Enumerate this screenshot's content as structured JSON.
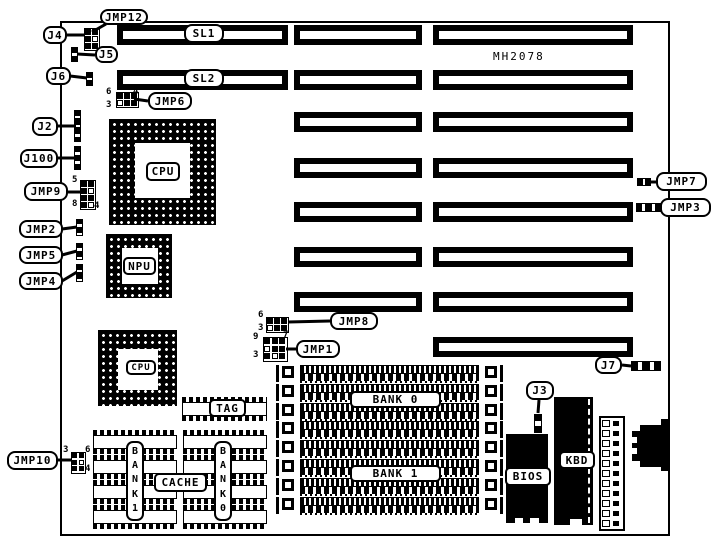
{
  "palette": {
    "ink": "#000000",
    "paper": "#ffffff"
  },
  "board": {
    "x": 60,
    "y": 21,
    "w": 610,
    "h": 515,
    "model_text": "MH2078",
    "model": {
      "x": 493,
      "y": 50,
      "w": 62,
      "h": 14
    }
  },
  "slots": [
    {
      "x": 117,
      "y": 25,
      "w": 171,
      "h": 20
    },
    {
      "x": 294,
      "y": 25,
      "w": 128,
      "h": 20
    },
    {
      "x": 433,
      "y": 25,
      "w": 200,
      "h": 20
    },
    {
      "x": 117,
      "y": 70,
      "w": 171,
      "h": 20
    },
    {
      "x": 294,
      "y": 70,
      "w": 128,
      "h": 20
    },
    {
      "x": 433,
      "y": 70,
      "w": 200,
      "h": 20
    },
    {
      "x": 294,
      "y": 112,
      "w": 128,
      "h": 20
    },
    {
      "x": 433,
      "y": 112,
      "w": 200,
      "h": 20
    },
    {
      "x": 294,
      "y": 158,
      "w": 128,
      "h": 20
    },
    {
      "x": 433,
      "y": 158,
      "w": 200,
      "h": 20
    },
    {
      "x": 294,
      "y": 202,
      "w": 128,
      "h": 20
    },
    {
      "x": 433,
      "y": 202,
      "w": 200,
      "h": 20
    },
    {
      "x": 294,
      "y": 247,
      "w": 128,
      "h": 20
    },
    {
      "x": 433,
      "y": 247,
      "w": 200,
      "h": 20
    },
    {
      "x": 294,
      "y": 292,
      "w": 128,
      "h": 20
    },
    {
      "x": 433,
      "y": 292,
      "w": 200,
      "h": 20
    },
    {
      "x": 433,
      "y": 337,
      "w": 200,
      "h": 20
    }
  ],
  "sockets": [
    {
      "name": "cpu-socket",
      "label": "CPU",
      "x": 109,
      "y": 119,
      "w": 107,
      "h": 106,
      "inner": [
        26,
        24,
        55,
        55
      ],
      "box": {
        "x": 146,
        "y": 162,
        "w": 34,
        "h": 19
      },
      "fs": 11
    },
    {
      "name": "npu-socket",
      "label": "NPU",
      "x": 106,
      "y": 234,
      "w": 66,
      "h": 64,
      "inner": [
        16,
        14,
        36,
        36
      ],
      "box": {
        "x": 123,
        "y": 257,
        "w": 33,
        "h": 18
      },
      "fs": 11
    },
    {
      "name": "cpu2-socket",
      "label": "CPU",
      "x": 98,
      "y": 330,
      "w": 79,
      "h": 76,
      "inner": [
        20,
        19,
        40,
        41
      ],
      "box": {
        "x": 126,
        "y": 360,
        "w": 30,
        "h": 15
      },
      "fs": 9
    }
  ],
  "cpu2_pin1_marker": {
    "x": 148,
    "y": 378,
    "w": 5,
    "h": 5
  },
  "simm": {
    "x": 276,
    "w": 227,
    "h": 17,
    "row_ys": [
      365,
      384,
      403,
      421,
      440,
      459,
      478,
      497
    ],
    "bank_labels": [
      {
        "text": "BANK 0",
        "x": 350,
        "y": 391,
        "w": 91,
        "h": 17
      },
      {
        "text": "BANK 1",
        "x": 350,
        "y": 465,
        "w": 91,
        "h": 17
      }
    ]
  },
  "dip_chips": [
    {
      "x": 182,
      "y": 397,
      "w": 85,
      "h": 24
    },
    {
      "x": 93,
      "y": 430,
      "w": 84,
      "h": 24
    },
    {
      "x": 93,
      "y": 455,
      "w": 84,
      "h": 24
    },
    {
      "x": 93,
      "y": 480,
      "w": 84,
      "h": 24
    },
    {
      "x": 93,
      "y": 505,
      "w": 84,
      "h": 24
    },
    {
      "x": 183,
      "y": 430,
      "w": 84,
      "h": 24
    },
    {
      "x": 183,
      "y": 455,
      "w": 84,
      "h": 24
    },
    {
      "x": 183,
      "y": 480,
      "w": 84,
      "h": 24
    },
    {
      "x": 183,
      "y": 505,
      "w": 84,
      "h": 24
    }
  ],
  "vlabels": [
    {
      "name": "cache-bank1-label",
      "text": "B\nA\nN\nK\n1",
      "x": 126,
      "y": 441,
      "w": 18,
      "h": 80
    },
    {
      "name": "cache-bank0-label",
      "text": "B\nA\nN\nK\n0",
      "x": 214,
      "y": 441,
      "w": 18,
      "h": 80
    }
  ],
  "comp_labels": [
    {
      "name": "tag-chip-label",
      "text": "TAG",
      "x": 209,
      "y": 399,
      "w": 37,
      "h": 18
    },
    {
      "name": "cache-label",
      "text": "CACHE",
      "x": 154,
      "y": 473,
      "w": 53,
      "h": 19
    },
    {
      "name": "bios-chip-label",
      "text": "BIOS",
      "x": 505,
      "y": 467,
      "w": 46,
      "h": 19
    },
    {
      "name": "kbd-chip-label",
      "text": "KBD",
      "x": 559,
      "y": 451,
      "w": 36,
      "h": 18
    }
  ],
  "callouts": [
    {
      "id": "jmp12",
      "text": "JMP12",
      "x": 100,
      "y": 9,
      "w": 48,
      "h": 16,
      "tail": [
        106,
        24,
        92,
        32
      ]
    },
    {
      "id": "j4",
      "text": "J4",
      "x": 43,
      "y": 26,
      "w": 24,
      "h": 18,
      "tail": [
        66,
        35,
        85,
        35
      ]
    },
    {
      "id": "j5",
      "text": "J5",
      "x": 95,
      "y": 46,
      "w": 23,
      "h": 17,
      "tail": [
        95,
        55,
        77,
        54
      ]
    },
    {
      "id": "j6",
      "text": "J6",
      "x": 46,
      "y": 67,
      "w": 25,
      "h": 18,
      "tail": [
        70,
        76,
        87,
        78
      ]
    },
    {
      "id": "jmp6",
      "text": "JMP6",
      "x": 148,
      "y": 92,
      "w": 44,
      "h": 18,
      "tail": [
        148,
        101,
        134,
        99
      ]
    },
    {
      "id": "j2",
      "text": "J2",
      "x": 32,
      "y": 117,
      "w": 26,
      "h": 19,
      "tail": [
        57,
        126,
        76,
        126
      ]
    },
    {
      "id": "j100",
      "text": "J100",
      "x": 20,
      "y": 149,
      "w": 38,
      "h": 19,
      "tail": [
        57,
        158,
        75,
        158
      ]
    },
    {
      "id": "jmp9",
      "text": "JMP9",
      "x": 24,
      "y": 182,
      "w": 44,
      "h": 19,
      "tail": [
        67,
        192,
        81,
        192
      ]
    },
    {
      "id": "jmp2",
      "text": "JMP2",
      "x": 19,
      "y": 220,
      "w": 44,
      "h": 18,
      "tail": [
        62,
        229,
        77,
        227
      ]
    },
    {
      "id": "jmp5",
      "text": "JMP5",
      "x": 19,
      "y": 246,
      "w": 44,
      "h": 18,
      "tail": [
        62,
        255,
        77,
        251
      ]
    },
    {
      "id": "jmp4",
      "text": "JMP4",
      "x": 19,
      "y": 272,
      "w": 44,
      "h": 18,
      "tail": [
        62,
        281,
        77,
        272
      ]
    },
    {
      "id": "jmp7",
      "text": "JMP7",
      "x": 656,
      "y": 172,
      "w": 51,
      "h": 19,
      "tail": [
        657,
        182,
        650,
        182
      ]
    },
    {
      "id": "jmp3",
      "text": "JMP3",
      "x": 660,
      "y": 198,
      "w": 51,
      "h": 19,
      "tail": [
        662,
        208,
        659,
        207
      ]
    },
    {
      "id": "jmp8",
      "text": "JMP8",
      "x": 330,
      "y": 312,
      "w": 48,
      "h": 18,
      "tail": [
        330,
        321,
        288,
        322
      ]
    },
    {
      "id": "jmp1",
      "text": "JMP1",
      "x": 296,
      "y": 340,
      "w": 44,
      "h": 18,
      "tail": [
        296,
        349,
        286,
        349
      ]
    },
    {
      "id": "j7",
      "text": "J7",
      "x": 595,
      "y": 356,
      "w": 27,
      "h": 18,
      "tail": [
        622,
        365,
        631,
        366
      ]
    },
    {
      "id": "j3",
      "text": "J3",
      "x": 526,
      "y": 381,
      "w": 28,
      "h": 19,
      "tail": [
        539,
        400,
        538,
        413
      ]
    },
    {
      "id": "jmp10",
      "text": "JMP10",
      "x": 7,
      "y": 451,
      "w": 51,
      "h": 19,
      "tail": [
        58,
        460,
        71,
        460
      ]
    },
    {
      "id": "sl1",
      "text": "SL1",
      "x": 184,
      "y": 24,
      "w": 40,
      "h": 19
    },
    {
      "id": "sl2",
      "text": "SL2",
      "x": 184,
      "y": 69,
      "w": 40,
      "h": 19
    }
  ],
  "digits": [
    {
      "text": "6",
      "x": 106,
      "y": 88
    },
    {
      "text": "4",
      "x": 133,
      "y": 88
    },
    {
      "text": "3",
      "x": 106,
      "y": 101
    },
    {
      "text": "5",
      "x": 72,
      "y": 176
    },
    {
      "text": "8",
      "x": 72,
      "y": 200
    },
    {
      "text": "4",
      "x": 94,
      "y": 202
    },
    {
      "text": "6",
      "x": 258,
      "y": 311
    },
    {
      "text": "3",
      "x": 258,
      "y": 324
    },
    {
      "text": "9",
      "x": 253,
      "y": 333
    },
    {
      "text": "7",
      "x": 283,
      "y": 331
    },
    {
      "text": "3",
      "x": 253,
      "y": 351
    },
    {
      "text": "3",
      "x": 63,
      "y": 446
    },
    {
      "text": "6",
      "x": 85,
      "y": 446
    },
    {
      "text": "4",
      "x": 85,
      "y": 465
    }
  ],
  "grids": [
    {
      "name": "j4-jmp12-block",
      "x": 84,
      "y": 28,
      "cols": 2,
      "rows": 3,
      "cell": 7
    },
    {
      "name": "jmp6-block",
      "x": 116,
      "y": 92,
      "cols": 3,
      "rows": 2,
      "cell": 7
    },
    {
      "name": "jmp9-block",
      "x": 80,
      "y": 180,
      "cols": 2,
      "rows": 4,
      "cell": 7
    },
    {
      "name": "jmp8-block",
      "x": 266,
      "y": 317,
      "cols": 3,
      "rows": 2,
      "cell": 7
    },
    {
      "name": "jmp1-block",
      "x": 263,
      "y": 337,
      "cols": 3,
      "rows": 3,
      "cell": 7.5
    },
    {
      "name": "jmp10-block",
      "x": 71,
      "y": 452,
      "cols": 2,
      "rows": 3,
      "cell": 6.5
    }
  ],
  "strips": [
    {
      "name": "j5-jumper",
      "x": 71,
      "y": 47,
      "dir": "v",
      "n": 3,
      "cw": 7,
      "ch": 5
    },
    {
      "name": "j6-jumper",
      "x": 86,
      "y": 72,
      "dir": "v",
      "n": 3,
      "cw": 7,
      "ch": 4.7
    },
    {
      "name": "j2-header",
      "x": 74,
      "y": 110,
      "dir": "v",
      "n": 7,
      "cw": 7,
      "ch": 4.6
    },
    {
      "name": "j100-header",
      "x": 74,
      "y": 146,
      "dir": "v",
      "n": 5,
      "cw": 7,
      "ch": 4.8
    },
    {
      "name": "jmp2-jumper",
      "x": 76,
      "y": 219,
      "dir": "v",
      "n": 4,
      "cw": 7,
      "ch": 4.3
    },
    {
      "name": "jmp5-jumper",
      "x": 76,
      "y": 243,
      "dir": "v",
      "n": 4,
      "cw": 7,
      "ch": 4.3
    },
    {
      "name": "jmp4-jumper",
      "x": 76,
      "y": 264,
      "dir": "v",
      "n": 4,
      "cw": 7,
      "ch": 4.5
    },
    {
      "name": "j3-jumper",
      "x": 534,
      "y": 414,
      "dir": "v",
      "n": 3,
      "cw": 8,
      "ch": 6.3
    },
    {
      "name": "jmp7-jumper",
      "x": 637,
      "y": 178,
      "dir": "h",
      "n": 3,
      "cw": 4.7,
      "ch": 8
    },
    {
      "name": "jmp3-jumper",
      "x": 636,
      "y": 203,
      "dir": "h",
      "n": 5,
      "cw": 5,
      "ch": 9
    },
    {
      "name": "j7-jumper",
      "x": 631,
      "y": 361,
      "dir": "h",
      "n": 5,
      "cw": 6,
      "ch": 10
    }
  ],
  "solid_chips": [
    {
      "name": "bios-chip",
      "x": 506,
      "y": 434,
      "w": 42,
      "h": 89
    },
    {
      "name": "kbd-chip",
      "x": 554,
      "y": 397,
      "w": 39,
      "h": 128
    }
  ],
  "white_notches": [
    {
      "x": 515,
      "y": 518,
      "w": 8,
      "h": 7
    },
    {
      "x": 530,
      "y": 518,
      "w": 9,
      "h": 7
    },
    {
      "x": 570,
      "y": 519,
      "w": 12,
      "h": 7
    }
  ],
  "kbd_dash": {
    "x": 588,
    "y": 399,
    "h": 124
  },
  "power_connector": {
    "x": 599,
    "y": 416,
    "w": 26,
    "h": 115,
    "pins": 11
  },
  "din_connector": {
    "rects": [
      {
        "x": 661,
        "y": 419,
        "w": 8,
        "h": 52
      },
      {
        "x": 640,
        "y": 425,
        "w": 21,
        "h": 42
      },
      {
        "x": 632,
        "y": 431,
        "w": 9,
        "h": 30
      }
    ],
    "notches": [
      {
        "x": 632,
        "y": 437,
        "w": 5,
        "h": 6
      },
      {
        "x": 632,
        "y": 448,
        "w": 5,
        "h": 6
      }
    ]
  }
}
